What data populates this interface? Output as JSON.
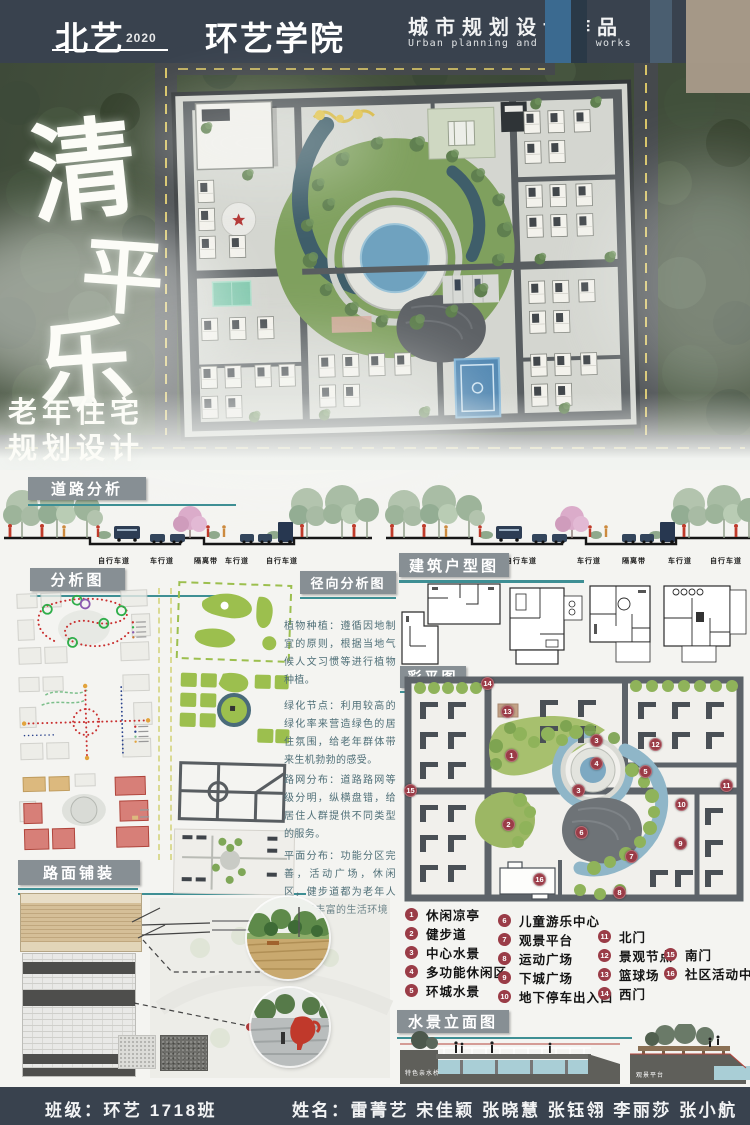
{
  "header": {
    "brand": "北艺",
    "year": "2020",
    "college": "环艺学院",
    "title_cn": "城市规划设计作品",
    "title_en": "Urban planning and design works"
  },
  "hero": {
    "c1": "清",
    "c2": "平",
    "c3": "乐",
    "sub1": "老年住宅",
    "sub2": "规划设计"
  },
  "road": {
    "label": "道路分析",
    "lanes": [
      "自行车道",
      "车行道",
      "隔离带",
      "车行道",
      "自行车道"
    ]
  },
  "sections": {
    "analysis": "分析图",
    "radial": "径向分析图",
    "floorplan": "建筑户型图",
    "colorplan": "彩平图",
    "pavement": "路面铺装",
    "water": "水景立面图"
  },
  "notes": [
    "植物种植：遵循因地制宜的原则，根据当地气候人文习惯等进行植物种植。",
    "绿化节点：利用较高的绿化率来营造绿色的居住氛围，给老年群体带来生机勃勃的感受。",
    "路网分布：道路路网等级分明，纵横盘错，给居住人群提供不同类型的服务。",
    "平面分布：功能分区完善，活动广场，休闲区，健步道都为老年人提供了丰富的生活环境"
  ],
  "colorplan": {
    "markers": [
      "14",
      "13",
      "3",
      "12",
      "1",
      "4",
      "5",
      "15",
      "3",
      "11",
      "10",
      "2",
      "6",
      "9",
      "7",
      "16",
      "8"
    ]
  },
  "legend": {
    "items": [
      {
        "num": "1",
        "label": "休闲凉亭"
      },
      {
        "num": "2",
        "label": "健步道"
      },
      {
        "num": "3",
        "label": "中心水景"
      },
      {
        "num": "4",
        "label": "多功能休闲区"
      },
      {
        "num": "5",
        "label": "环城水景"
      },
      {
        "num": "6",
        "label": "儿童游乐中心"
      },
      {
        "num": "7",
        "label": "观景平台"
      },
      {
        "num": "8",
        "label": "运动广场"
      },
      {
        "num": "9",
        "label": "下城广场"
      },
      {
        "num": "10",
        "label": "地下停车出入口"
      },
      {
        "num": "11",
        "label": "北门"
      },
      {
        "num": "12",
        "label": "景观节点"
      },
      {
        "num": "13",
        "label": "篮球场"
      },
      {
        "num": "14",
        "label": "西门"
      },
      {
        "num": "15",
        "label": "南门"
      },
      {
        "num": "16",
        "label": "社区活动中心"
      }
    ]
  },
  "water": {
    "cap1": "特色亲水桥",
    "cap2": "观景平台"
  },
  "footer": {
    "class": "班级：环艺 1718班",
    "names": "姓名：雷菁艺 宋佳颖 张晓慧 张钰翎 李丽莎 张小航"
  },
  "colors": {
    "slate": "#39424E",
    "teal": "#3E8F94",
    "badge": "#878F94",
    "legend_red": "#9A3C47"
  }
}
